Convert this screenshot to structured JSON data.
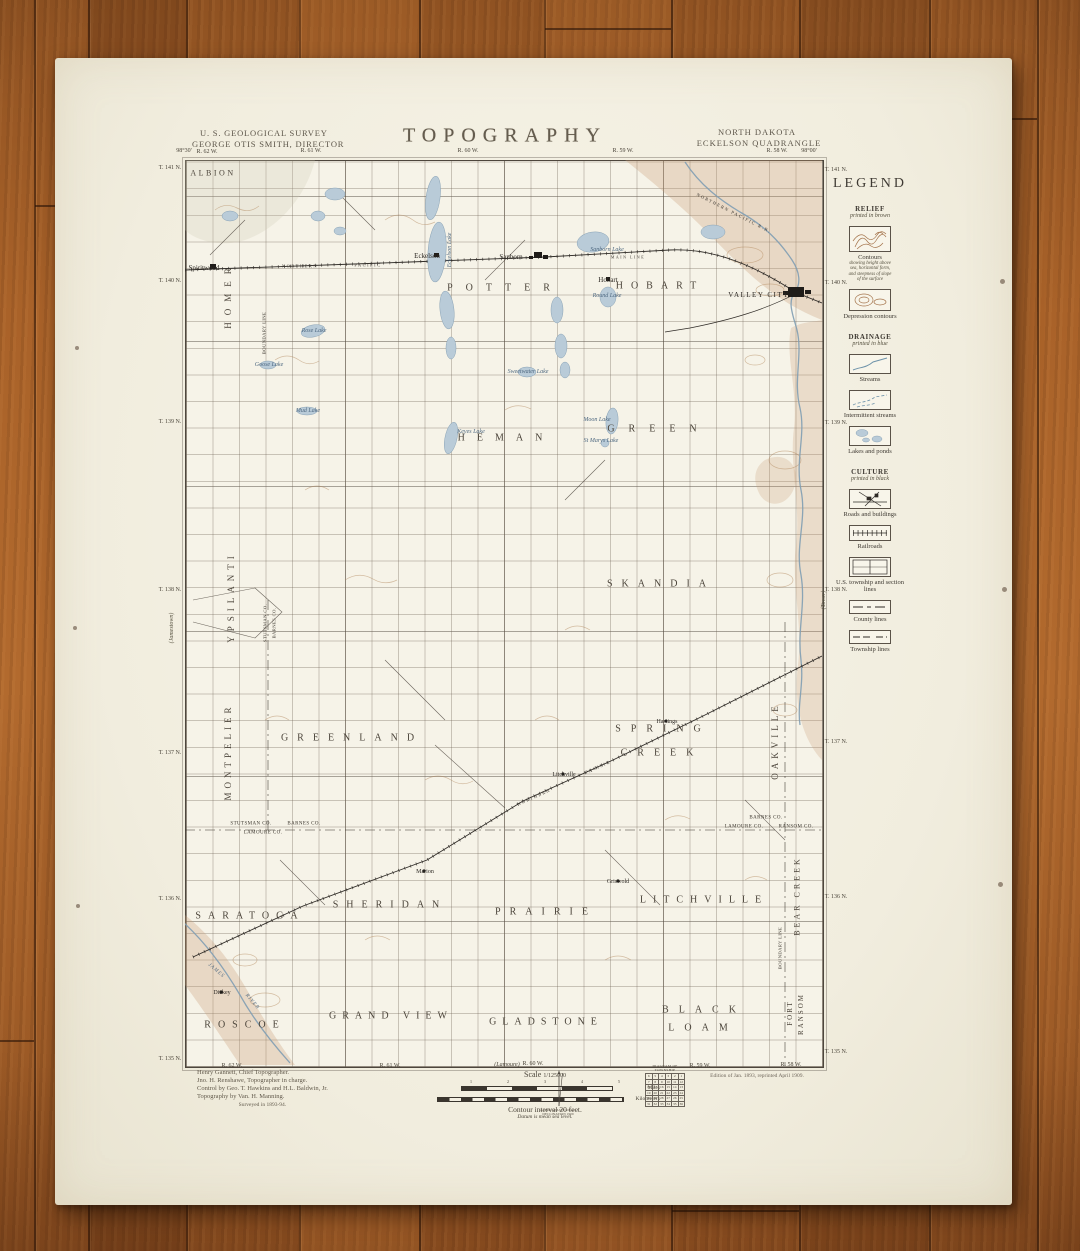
{
  "header": {
    "survey_line1": "U. S. GEOLOGICAL SURVEY",
    "survey_line2": "GEORGE OTIS SMITH, DIRECTOR",
    "title": "TOPOGRAPHY",
    "state": "NORTH DAKOTA",
    "quadrangle": "ECKELSON QUADRANGLE"
  },
  "legend": {
    "title": "LEGEND",
    "sections": [
      {
        "heading": "RELIEF",
        "sub": "printed in brown",
        "items": [
          {
            "label": "Contours",
            "art": "contours",
            "sublines": [
              "showing height above",
              "sea, horizontal form,",
              "and steepness of slope",
              "of the surface"
            ]
          },
          {
            "label": "Depression contours",
            "art": "depression"
          }
        ]
      },
      {
        "heading": "DRAINAGE",
        "sub": "printed in blue",
        "items": [
          {
            "label": "Streams",
            "art": "stream"
          },
          {
            "label": "Intermittent streams",
            "art": "intermittent"
          },
          {
            "label": "Lakes and ponds",
            "art": "lakes"
          }
        ]
      },
      {
        "heading": "CULTURE",
        "sub": "printed in black",
        "items": [
          {
            "label": "Roads and buildings",
            "art": "roads"
          },
          {
            "label": "Railroads",
            "art": "railroad"
          },
          {
            "label": "U.S. township and section lines",
            "art": "sections"
          },
          {
            "label": "County lines",
            "art": "county"
          },
          {
            "label": "Township lines",
            "art": "township"
          }
        ]
      }
    ]
  },
  "map": {
    "labels": [
      {
        "t": "ALBION",
        "x": 213,
        "y": 173,
        "c": "twp",
        "s": 8,
        "ls": 2.5
      },
      {
        "t": "POTTER",
        "x": 505,
        "y": 288,
        "c": "twp",
        "ls": 13
      },
      {
        "t": "HOBART",
        "x": 660,
        "y": 286,
        "c": "twp",
        "ls": 8
      },
      {
        "t": "GREEN",
        "x": 659,
        "y": 429,
        "c": "twp",
        "ls": 14
      },
      {
        "t": "HEMAN",
        "x": 506,
        "y": 438,
        "c": "twp",
        "ls": 12
      },
      {
        "t": "SKANDIA",
        "x": 661,
        "y": 584,
        "c": "twp",
        "ls": 9
      },
      {
        "t": "GREENLAND",
        "x": 352,
        "y": 738,
        "c": "twp",
        "ls": 9
      },
      {
        "t": "SPRING",
        "x": 663,
        "y": 729,
        "c": "twp",
        "ls": 10
      },
      {
        "t": "CREEK",
        "x": 662,
        "y": 753,
        "c": "twp",
        "ls": 10
      },
      {
        "t": "SARATOGA",
        "x": 250,
        "y": 916,
        "c": "twp",
        "ls": 7
      },
      {
        "t": "SHERIDAN",
        "x": 390,
        "y": 905,
        "c": "twp",
        "ls": 8
      },
      {
        "t": "PRAIRIE",
        "x": 546,
        "y": 912,
        "c": "twp",
        "ls": 9
      },
      {
        "t": "LITCHVILLE",
        "x": 704,
        "y": 900,
        "c": "twp",
        "ls": 7
      },
      {
        "t": "ROSCOE",
        "x": 245,
        "y": 1025,
        "c": "twp",
        "ls": 7
      },
      {
        "t": "GRAND VIEW",
        "x": 391,
        "y": 1016,
        "c": "twp",
        "ls": 6
      },
      {
        "t": "GLADSTONE",
        "x": 546,
        "y": 1022,
        "c": "twp",
        "ls": 6
      },
      {
        "t": "BLACK",
        "x": 704,
        "y": 1010,
        "c": "twp",
        "ls": 10
      },
      {
        "t": "LOAM",
        "x": 703,
        "y": 1028,
        "c": "twp",
        "ls": 10
      },
      {
        "t": "HOMER",
        "x": 228,
        "y": 295,
        "c": "twpv",
        "ls": 7
      },
      {
        "t": "YPSILANTI",
        "x": 231,
        "y": 597,
        "c": "twpv",
        "ls": 5
      },
      {
        "t": "MONTPELIER",
        "x": 228,
        "y": 752,
        "c": "twpv",
        "ls": 4
      },
      {
        "t": "OAKVILLE",
        "x": 775,
        "y": 741,
        "c": "twpv",
        "ls": 4
      },
      {
        "t": "BEAR CREEK",
        "x": 797,
        "y": 896,
        "c": "twpv",
        "s": 8,
        "ls": 3
      },
      {
        "t": "FORT",
        "x": 790,
        "y": 1013,
        "c": "twpv",
        "s": 7,
        "ls": 2
      },
      {
        "t": "RANSOM",
        "x": 801,
        "y": 1014,
        "c": "twpv",
        "s": 7,
        "ls": 2
      },
      {
        "t": "BOUNDARY LINE",
        "x": 264,
        "y": 333,
        "c": "cntyv"
      },
      {
        "t": "BOUNDARY LINE",
        "x": 780,
        "y": 948,
        "c": "cntyv"
      },
      {
        "t": "STUTSMAN CO.",
        "x": 265,
        "y": 623,
        "c": "cntyv"
      },
      {
        "t": "BARNES CO.",
        "x": 274,
        "y": 623,
        "c": "cntyv"
      },
      {
        "t": "Spiritwood",
        "x": 204,
        "y": 268,
        "c": "town"
      },
      {
        "t": "Eckelson",
        "x": 427,
        "y": 256,
        "c": "town"
      },
      {
        "t": "Sanborn",
        "x": 511,
        "y": 257,
        "c": "town"
      },
      {
        "t": "Hobart",
        "x": 608,
        "y": 280,
        "c": "town"
      },
      {
        "t": "VALLEY CITY",
        "x": 759,
        "y": 295,
        "c": "towncaps"
      },
      {
        "t": "Litchville",
        "x": 564,
        "y": 775,
        "c": "town",
        "s": 6
      },
      {
        "t": "Hastings",
        "x": 667,
        "y": 722,
        "c": "town",
        "s": 6
      },
      {
        "t": "Marion",
        "x": 425,
        "y": 872,
        "c": "town",
        "s": 6
      },
      {
        "t": "Griswold",
        "x": 618,
        "y": 882,
        "c": "town",
        "s": 6
      },
      {
        "t": "Dickey",
        "x": 222,
        "y": 993,
        "c": "town",
        "s": 6
      },
      {
        "t": "Sanborn Lake",
        "x": 607,
        "y": 250,
        "c": "lake"
      },
      {
        "t": "Round Lake",
        "x": 607,
        "y": 296,
        "c": "lake"
      },
      {
        "t": "Rose Lake",
        "x": 314,
        "y": 331,
        "c": "lake"
      },
      {
        "t": "Goose Lake",
        "x": 269,
        "y": 365,
        "c": "lake"
      },
      {
        "t": "Mud Lake",
        "x": 308,
        "y": 411,
        "c": "lake"
      },
      {
        "t": "Keyes Lake",
        "x": 471,
        "y": 432,
        "c": "lake"
      },
      {
        "t": "Moon Lake",
        "x": 597,
        "y": 420,
        "c": "lake"
      },
      {
        "t": "St Marys Lake",
        "x": 601,
        "y": 441,
        "c": "lake"
      },
      {
        "t": "Sweetwater Lake",
        "x": 528,
        "y": 372,
        "c": "lake"
      },
      {
        "t": "Eckelson Lake",
        "x": 450,
        "y": 250,
        "c": "lakev"
      },
      {
        "t": "NORTHERN",
        "x": 300,
        "y": 266,
        "c": "rr"
      },
      {
        "t": "PACIFIC",
        "x": 368,
        "y": 265,
        "c": "rr"
      },
      {
        "t": "MAIN LINE",
        "x": 628,
        "y": 257,
        "c": "rr",
        "s": 4
      },
      {
        "t": "NORTHERN PACIFIC R.R.",
        "x": 734,
        "y": 213,
        "c": "rr",
        "r": 27
      },
      {
        "t": "NORTHERN",
        "x": 534,
        "y": 797,
        "c": "rr",
        "r": -24
      },
      {
        "t": "PACIFIC",
        "x": 598,
        "y": 767,
        "c": "rr",
        "r": -24
      },
      {
        "t": "JAMES",
        "x": 216,
        "y": 971,
        "c": "riv",
        "r": 40
      },
      {
        "t": "RIVER",
        "x": 252,
        "y": 1002,
        "c": "riv",
        "r": 50
      },
      {
        "t": "STUTSMAN CO.",
        "x": 251,
        "y": 824,
        "c": "cnty"
      },
      {
        "t": "BARNES CO.",
        "x": 304,
        "y": 824,
        "c": "cnty"
      },
      {
        "t": "LAMOURE CO.",
        "x": 263,
        "y": 833,
        "c": "cnty"
      },
      {
        "t": "BARNES CO.",
        "x": 766,
        "y": 818,
        "c": "cnty"
      },
      {
        "t": "LAMOURE CO.",
        "x": 744,
        "y": 827,
        "c": "cnty"
      },
      {
        "t": "RANSOM CO.",
        "x": 796,
        "y": 827,
        "c": "cnty"
      },
      {
        "t": "98°30'",
        "x": 184,
        "y": 151,
        "c": "edge"
      },
      {
        "t": "R. 62 W.",
        "x": 207,
        "y": 152,
        "c": "edge"
      },
      {
        "t": "R. 61 W.",
        "x": 311,
        "y": 151,
        "c": "edge"
      },
      {
        "t": "R. 60 W.",
        "x": 468,
        "y": 151,
        "c": "edge"
      },
      {
        "t": "R. 59 W.",
        "x": 623,
        "y": 151,
        "c": "edge"
      },
      {
        "t": "R. 58 W.",
        "x": 777,
        "y": 151,
        "c": "edge"
      },
      {
        "t": "98°00'",
        "x": 809,
        "y": 151,
        "c": "edge"
      },
      {
        "t": "T. 141 N.",
        "x": 170,
        "y": 168,
        "c": "edge"
      },
      {
        "t": "T. 140 N.",
        "x": 170,
        "y": 281,
        "c": "edge"
      },
      {
        "t": "T. 139 N.",
        "x": 170,
        "y": 422,
        "c": "edge"
      },
      {
        "t": "T. 138 N.",
        "x": 170,
        "y": 590,
        "c": "edge"
      },
      {
        "t": "T. 137 N.",
        "x": 170,
        "y": 753,
        "c": "edge"
      },
      {
        "t": "T. 136 N.",
        "x": 170,
        "y": 899,
        "c": "edge"
      },
      {
        "t": "T. 135 N.",
        "x": 170,
        "y": 1059,
        "c": "edge"
      },
      {
        "t": "T. 141 N.",
        "x": 836,
        "y": 170,
        "c": "edge"
      },
      {
        "t": "T. 140 N.",
        "x": 836,
        "y": 283,
        "c": "edge"
      },
      {
        "t": "T. 139 N.",
        "x": 836,
        "y": 423,
        "c": "edge"
      },
      {
        "t": "T. 138 N.",
        "x": 836,
        "y": 590,
        "c": "edge"
      },
      {
        "t": "T. 137 N.",
        "x": 836,
        "y": 742,
        "c": "edge"
      },
      {
        "t": "T. 136 N.",
        "x": 836,
        "y": 897,
        "c": "edge"
      },
      {
        "t": "T. 135 N.",
        "x": 836,
        "y": 1052,
        "c": "edge"
      },
      {
        "t": "R. 62 W.",
        "x": 232,
        "y": 1066,
        "c": "edge"
      },
      {
        "t": "R. 61 W.",
        "x": 390,
        "y": 1066,
        "c": "edge"
      },
      {
        "t": "R. 60 W.",
        "x": 533,
        "y": 1064,
        "c": "edge"
      },
      {
        "t": "R. 59 W.",
        "x": 700,
        "y": 1066,
        "c": "edge"
      },
      {
        "t": "R. 58 W.",
        "x": 791,
        "y": 1065,
        "c": "edge"
      },
      {
        "t": "(Lamoure)",
        "x": 507,
        "y": 1065,
        "c": "edgei"
      },
      {
        "t": "(Jamestown)",
        "x": 172,
        "y": 628,
        "c": "sheetv"
      },
      {
        "t": "(Tower)",
        "x": 824,
        "y": 600,
        "c": "sheetv"
      }
    ]
  },
  "footer": {
    "credits": [
      "Henry Gannett, Chief Topographer.",
      "Jno. H. Renshawe, Topographer in charge.",
      "Control by Geo. T. Hawkins and H.L. Baldwin, Jr.",
      "Topography by Van. H. Manning.",
      "Surveyed in 1893-94."
    ],
    "scale_prefix": "Scale",
    "scale_value": "1/125000",
    "miles_label": "Miles",
    "kilometers_label": "Kilometers",
    "miles_ticks": [
      "1",
      "2",
      "3",
      "4",
      "5"
    ],
    "contour_line": "Contour interval 20 feet.",
    "datum_line": "Datum is mean sea level.",
    "edition": "Edition of Jan. 1893, reprinted April 1909.",
    "declination_lines": [
      "APPROXIMATE MEAN",
      "DECLINATION 1909"
    ],
    "township_diagram_title": "DIAGRAM OF TOWNSHIP",
    "township_rows": [
      [
        6,
        5,
        4,
        3,
        2,
        1
      ],
      [
        7,
        8,
        9,
        10,
        11,
        12
      ],
      [
        18,
        17,
        16,
        15,
        14,
        13
      ],
      [
        19,
        20,
        21,
        22,
        23,
        24
      ],
      [
        30,
        29,
        28,
        27,
        26,
        25
      ],
      [
        31,
        32,
        33,
        34,
        35,
        36
      ]
    ]
  }
}
